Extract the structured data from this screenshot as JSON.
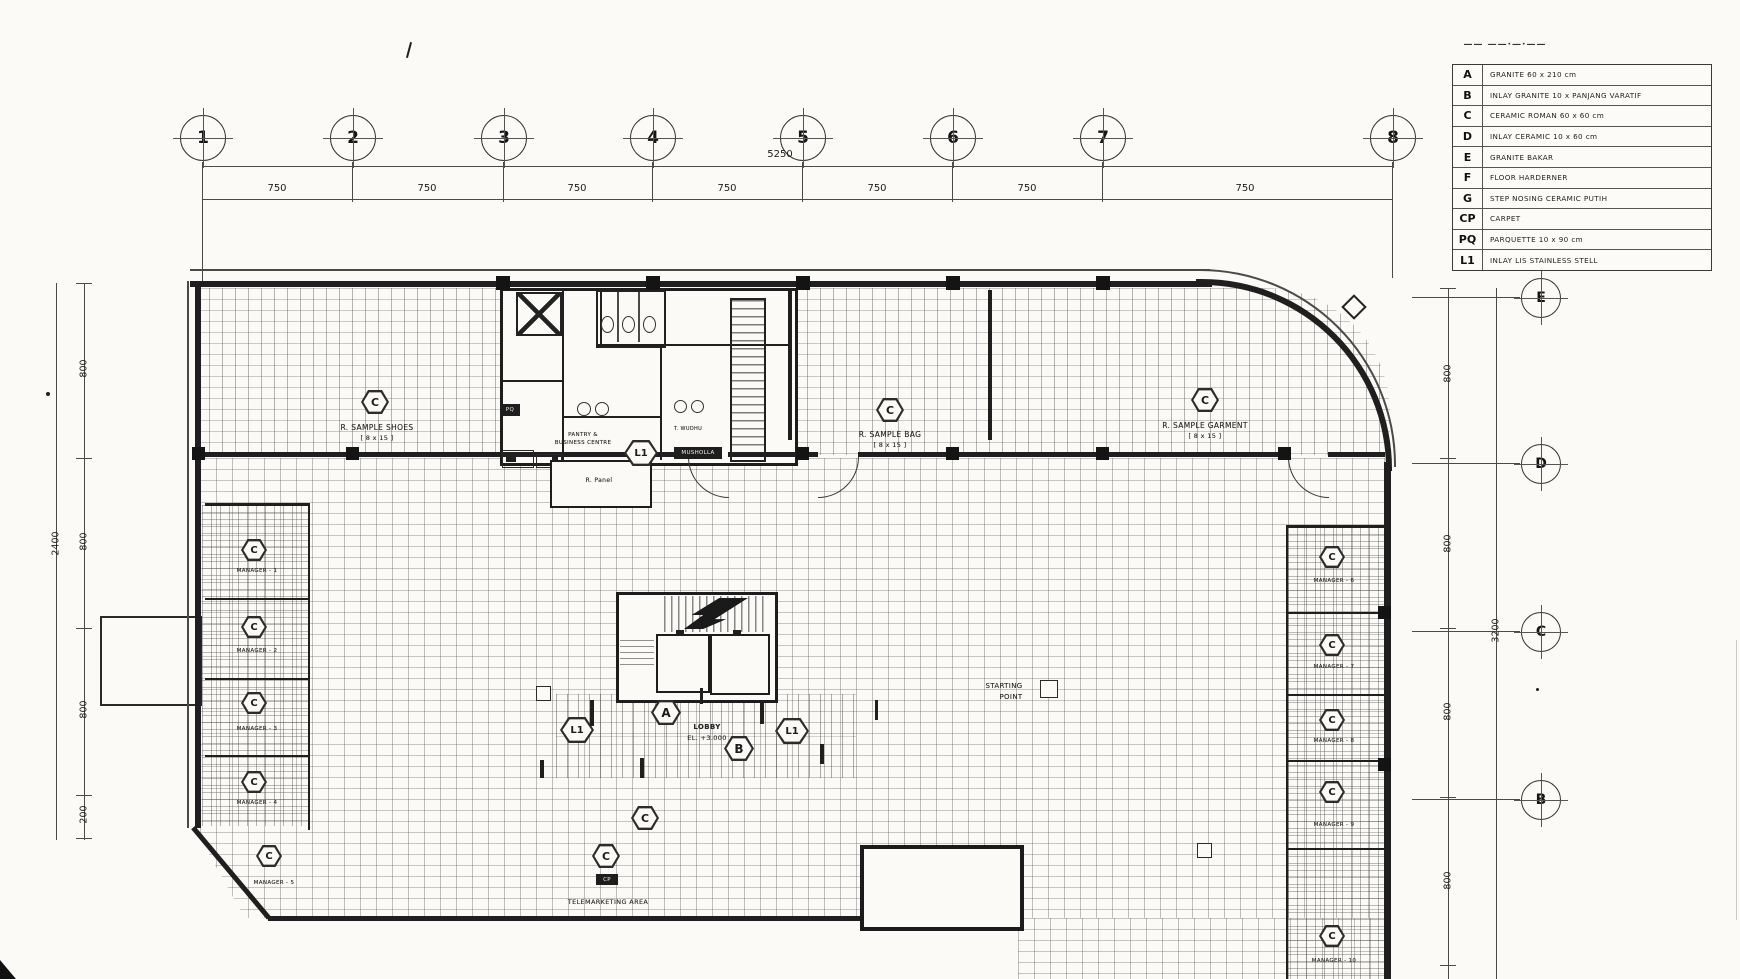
{
  "legend": {
    "title_marks": "—— ——·—·——",
    "rows": [
      {
        "code": "A",
        "desc": "GRANITE  60 x 210 cm"
      },
      {
        "code": "B",
        "desc": "INLAY GRANITE 10 x PANJANG VARATIF"
      },
      {
        "code": "C",
        "desc": "CERAMIC ROMAN  60 x 60 cm"
      },
      {
        "code": "D",
        "desc": "INLAY CERAMIC 10 x 60 cm"
      },
      {
        "code": "E",
        "desc": "GRANITE BAKAR"
      },
      {
        "code": "F",
        "desc": "FLOOR HARDERNER"
      },
      {
        "code": "G",
        "desc": "STEP NOSING CERAMIC PUTIH"
      },
      {
        "code": "CP",
        "desc": "CARPET"
      },
      {
        "code": "PQ",
        "desc": "PARQUETTE  10 x 90 cm"
      },
      {
        "code": "L1",
        "desc": "INLAY LIS STAINLESS STELL"
      }
    ]
  },
  "grid": {
    "columns": [
      "1",
      "2",
      "3",
      "4",
      "5",
      "6",
      "7",
      "8"
    ],
    "row_letters": [
      "E",
      "D",
      "C",
      "B"
    ],
    "top_total": "5250",
    "top_segments": [
      "750",
      "750",
      "750",
      "750",
      "750",
      "750",
      "750"
    ],
    "left_segments": [
      "800",
      "800",
      "800",
      "200"
    ],
    "left_total": "2400",
    "right_segments": [
      "800",
      "800",
      "800",
      "800"
    ],
    "right_total": "3200"
  },
  "rooms": {
    "sample_shoes": {
      "name": "R. SAMPLE SHOES",
      "size": "[ 8 x 15 ]"
    },
    "sample_bag": {
      "name": "R. SAMPLE BAG",
      "size": "[ 8 x 15 ]"
    },
    "sample_garment": {
      "name": "R. SAMPLE GARMENT",
      "size": "[ 8 x 15 ]"
    },
    "pantry": {
      "line1": "PANTRY &",
      "line2": "BUSINESS CENTRE"
    },
    "t_wudhu": "T. WUDHU",
    "musholla": "MUSHOLLA",
    "r_panel": "R. Panel",
    "pq_tag": "PQ",
    "lobby": {
      "line1": "LOBBY",
      "line2": "EL. +3.000"
    },
    "starting_point": {
      "line1": "STARTING",
      "line2": "POINT"
    },
    "telemarketing": "TELEMARKETING AREA",
    "cp_tag": "CP",
    "managers_left": [
      "MANAGER - 1",
      "MANAGER - 2",
      "MANAGER - 3",
      "MANAGER - 4",
      "MANAGER - 5"
    ],
    "managers_right": [
      "MANAGER - 6",
      "MANAGER - 7",
      "MANAGER - 8",
      "MANAGER - 9",
      "MANAGER - 10"
    ]
  },
  "symbols": {
    "c": "C",
    "a": "A",
    "b": "B",
    "l1": "L1"
  }
}
